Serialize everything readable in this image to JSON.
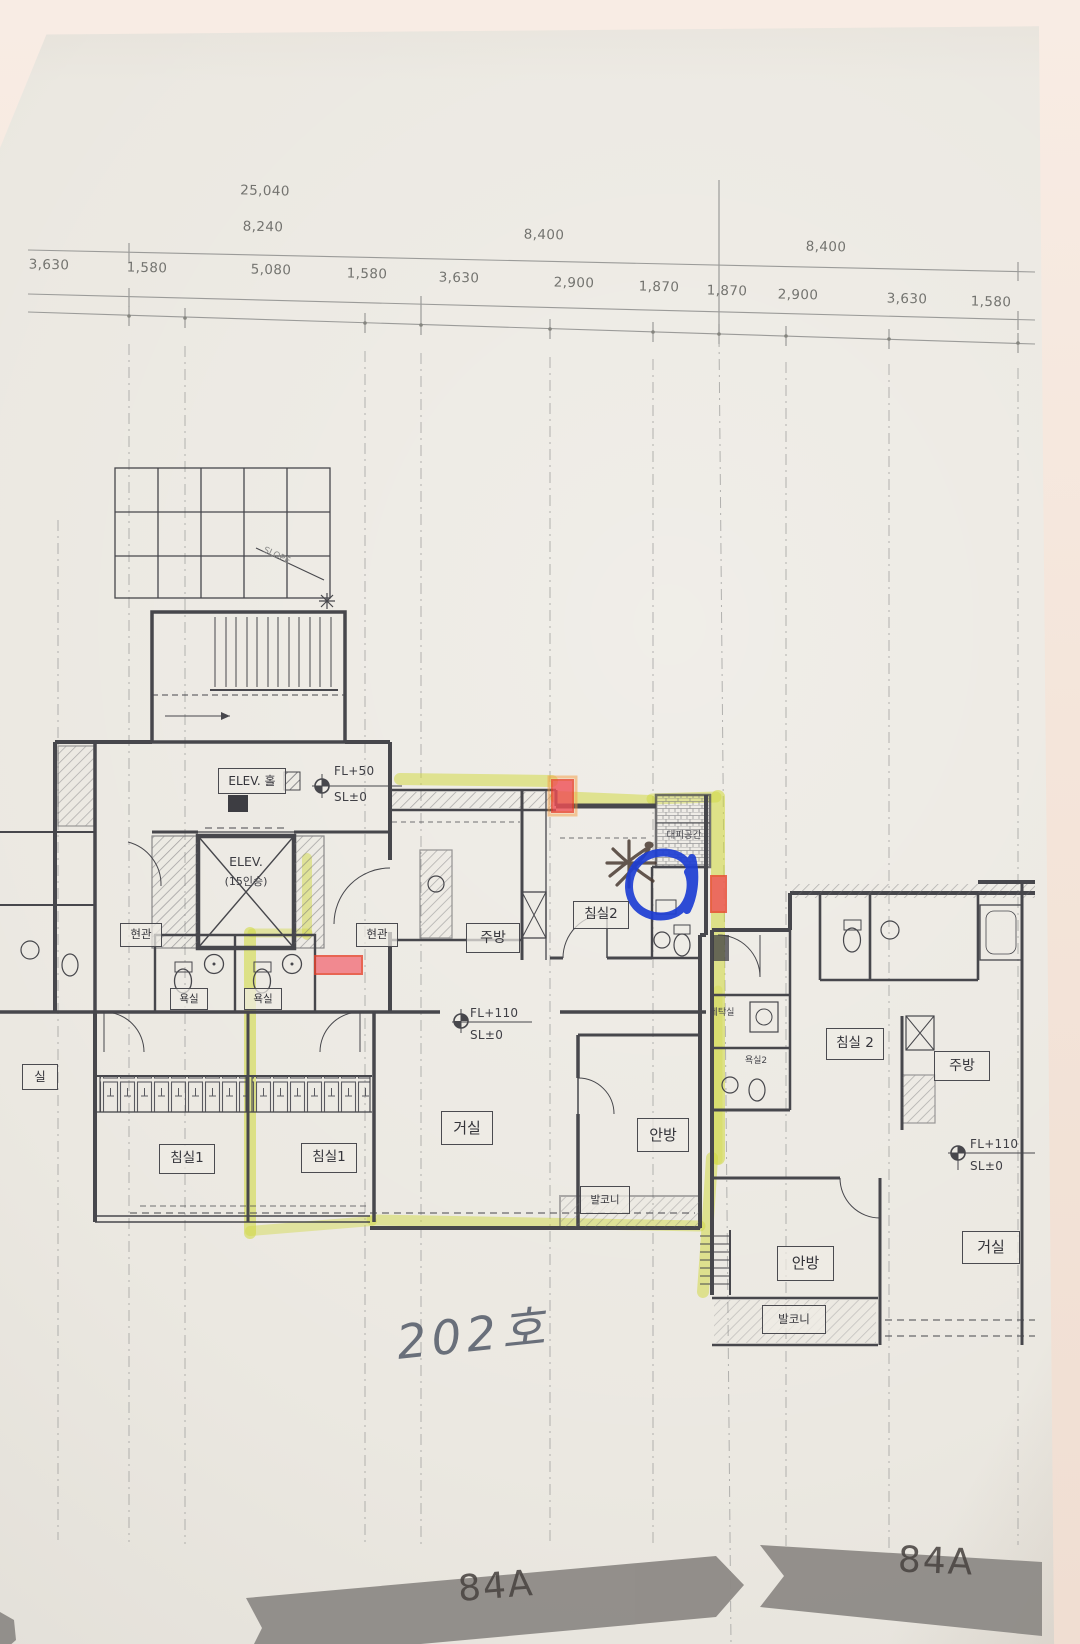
{
  "dims": {
    "total": "25,040",
    "row2": [
      "8,240",
      "8,400",
      "8,400"
    ],
    "row3": [
      "3,630",
      "1,580",
      "5,080",
      "1,580",
      "3,630",
      "2,900",
      "1,870",
      "1,870",
      "2,900",
      "3,630",
      "1,580"
    ]
  },
  "levels": {
    "hall_fl": "FL+50",
    "hall_sl": "SL±0",
    "left_fl": "FL+110",
    "left_sl": "SL±0",
    "right_fl": "FL+110",
    "right_sl": "SL±0"
  },
  "core": {
    "elev_hall": "ELEV. 홀",
    "elev": "ELEV.",
    "elev_cap": "(15인승)",
    "slope": "SLOPE"
  },
  "unit_left": {
    "entry1": "현관",
    "entry2": "현관",
    "bath1": "욕실",
    "bath2": "욕실",
    "kitchen": "주방",
    "bedroom2": "침실2",
    "refuge": "대피공간",
    "living": "거실",
    "master": "안방",
    "bedroom1a": "침실1",
    "bedroom1b": "침실1",
    "balcony": "발코니",
    "edge_partial": "실"
  },
  "unit_right": {
    "laundry": "세탁실",
    "bath": "욕실2",
    "bedroom2": "침실 2",
    "kitchen": "주방",
    "master": "안방",
    "living": "거실",
    "balcony": "발코니"
  },
  "ann": {
    "unit_no": "202호",
    "banner_left": "84A",
    "banner_right": "84A"
  },
  "colors": {
    "highlighter": "#cfd83a",
    "red_marker": "#ef4f55",
    "pen_blue": "#1d3ed4",
    "banner_gray": "#8f8b87"
  }
}
